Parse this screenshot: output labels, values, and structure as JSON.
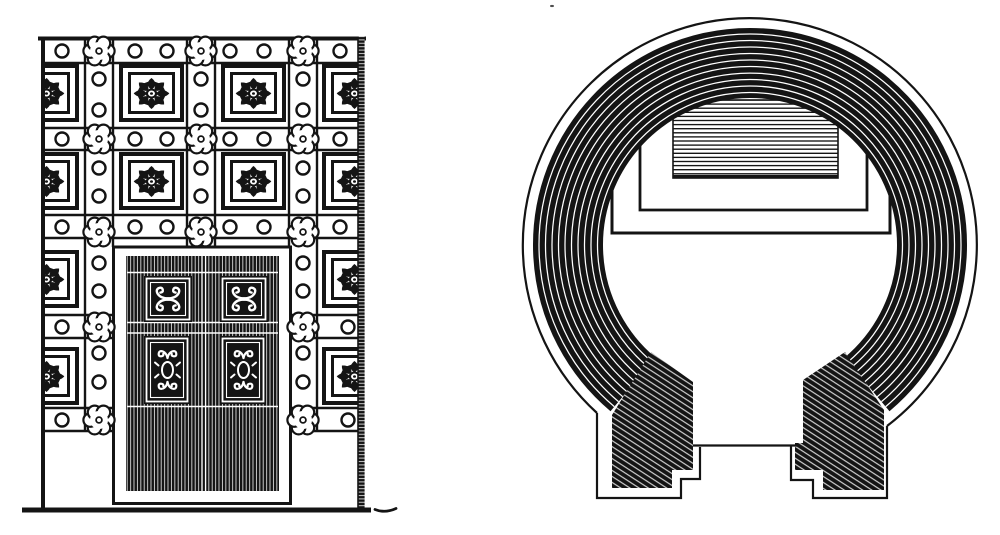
{
  "colors": {
    "paper": "#ffffff",
    "ink": "#141414"
  },
  "figures": {
    "left": {
      "name": "ornate-doorway-elevation"
    },
    "right": {
      "name": "circular-chamber-plan"
    }
  }
}
